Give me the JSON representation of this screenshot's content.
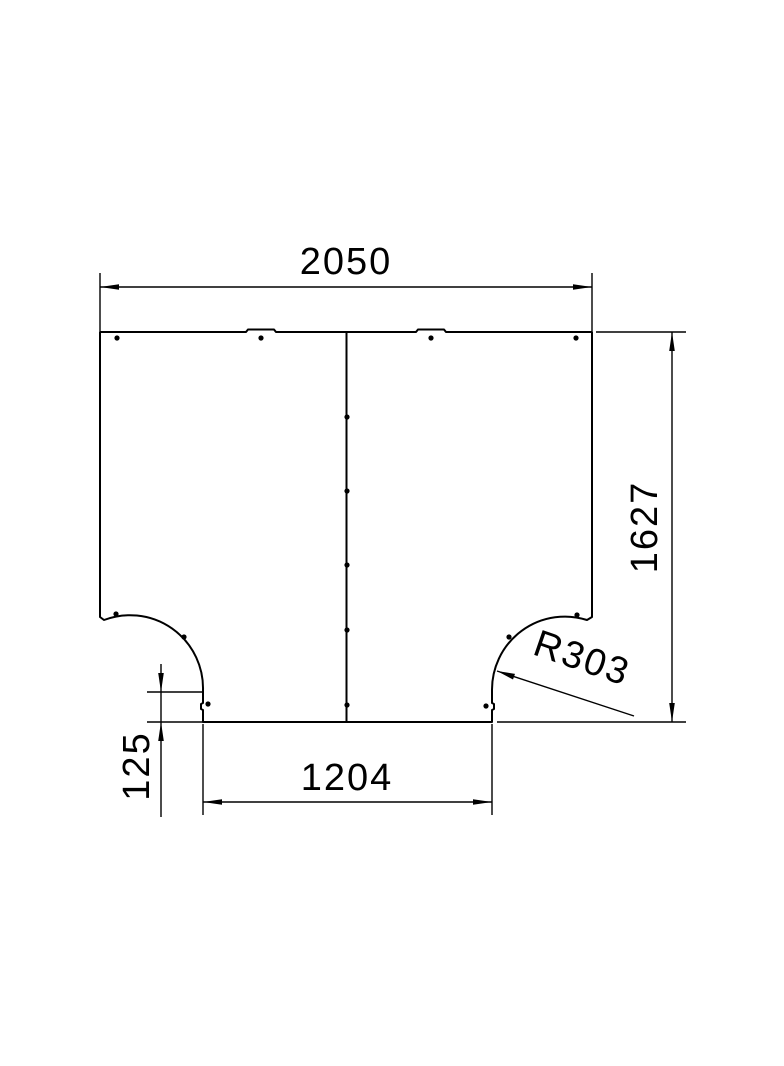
{
  "drawing": {
    "colors": {
      "line": "#000000",
      "background": "#ffffff"
    },
    "dimensions": {
      "overall_width": {
        "label": "2050",
        "value": 2050
      },
      "overall_height": {
        "label": "1627",
        "value": 1627
      },
      "branch_opening_width": {
        "label": "1204",
        "value": 1204
      },
      "edge_offset": {
        "label": "125",
        "value": 125
      },
      "corner_radius": {
        "label": "R303",
        "value": 303
      }
    }
  }
}
